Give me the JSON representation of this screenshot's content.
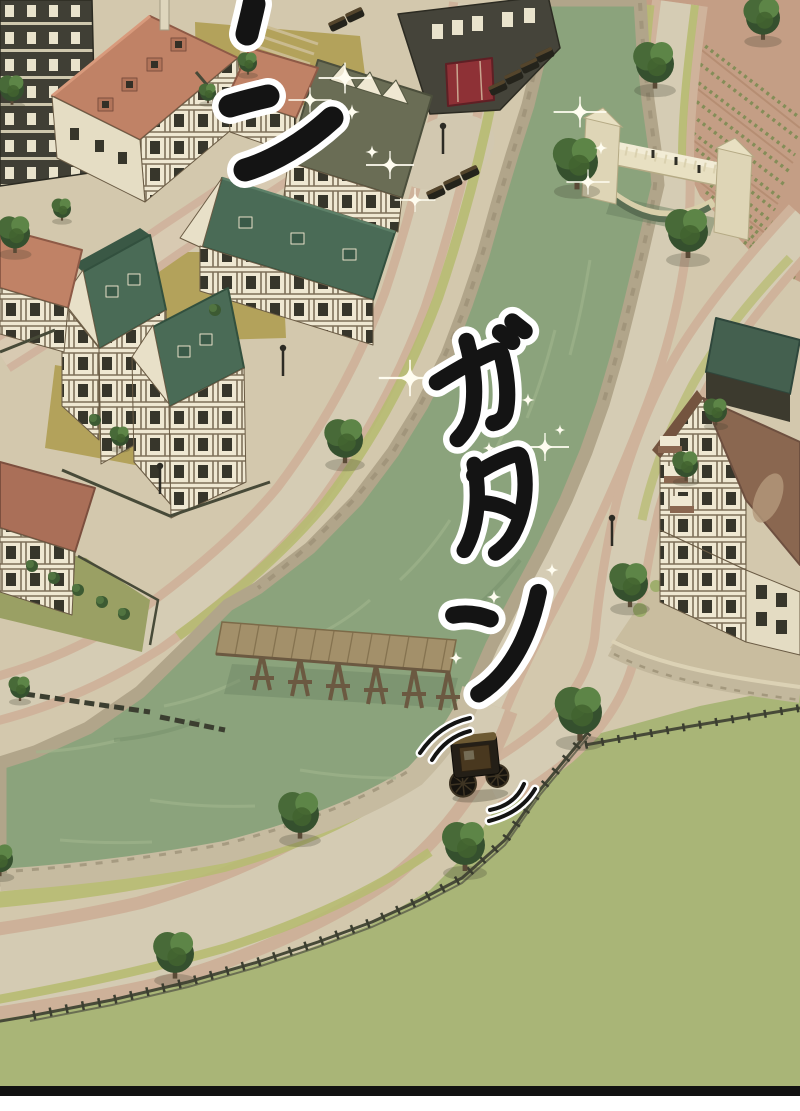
{
  "panel": {
    "scene_description": "Manga panel: aerial view of a half-timbered canal town with a stone bridge, wooden pier, vineyard slope and a horse-drawn carriage rattling along the waterfront road",
    "sfx": {
      "top": "ン",
      "main": "ガタン",
      "chars": [
        "ガ",
        "タ",
        "ン"
      ]
    },
    "colors": {
      "water": "#8ba37c",
      "water_shadow": "#75906a",
      "grass_field": "#a9b577",
      "grass_verge": "#b7bc72",
      "road_pink": "#cfb39b",
      "road_cobble": "#d5ccb4",
      "street_pink": "#d0b49e",
      "courtyard": "#b3a25b",
      "stone_wall": "#b1a58a",
      "quay_wall": "#c6bba0",
      "roof_salmon": "#c08266",
      "roof_teal": "#4a6b56",
      "roof_olive": "#6a6d55",
      "roof_brown": "#8a6750",
      "roof_rust": "#aa6f58",
      "timber_dark": "#403f35",
      "wall_cream": "#efe8d2",
      "bridge_stone": "#e8e0c2",
      "pier_wood": "#a3906a",
      "vineyard": "#c49e85",
      "vineyard_row": "#7e8c54",
      "tree_dark": "#35502e",
      "tree_light": "#5d8547",
      "carriage_body": "#241f17",
      "carriage_trim": "#6d5a33",
      "shop_red": "#8e3136",
      "fence": "#474a38",
      "sfx_ink": "#141414",
      "sfx_outline": "#ffffff",
      "border": "#111111"
    }
  }
}
